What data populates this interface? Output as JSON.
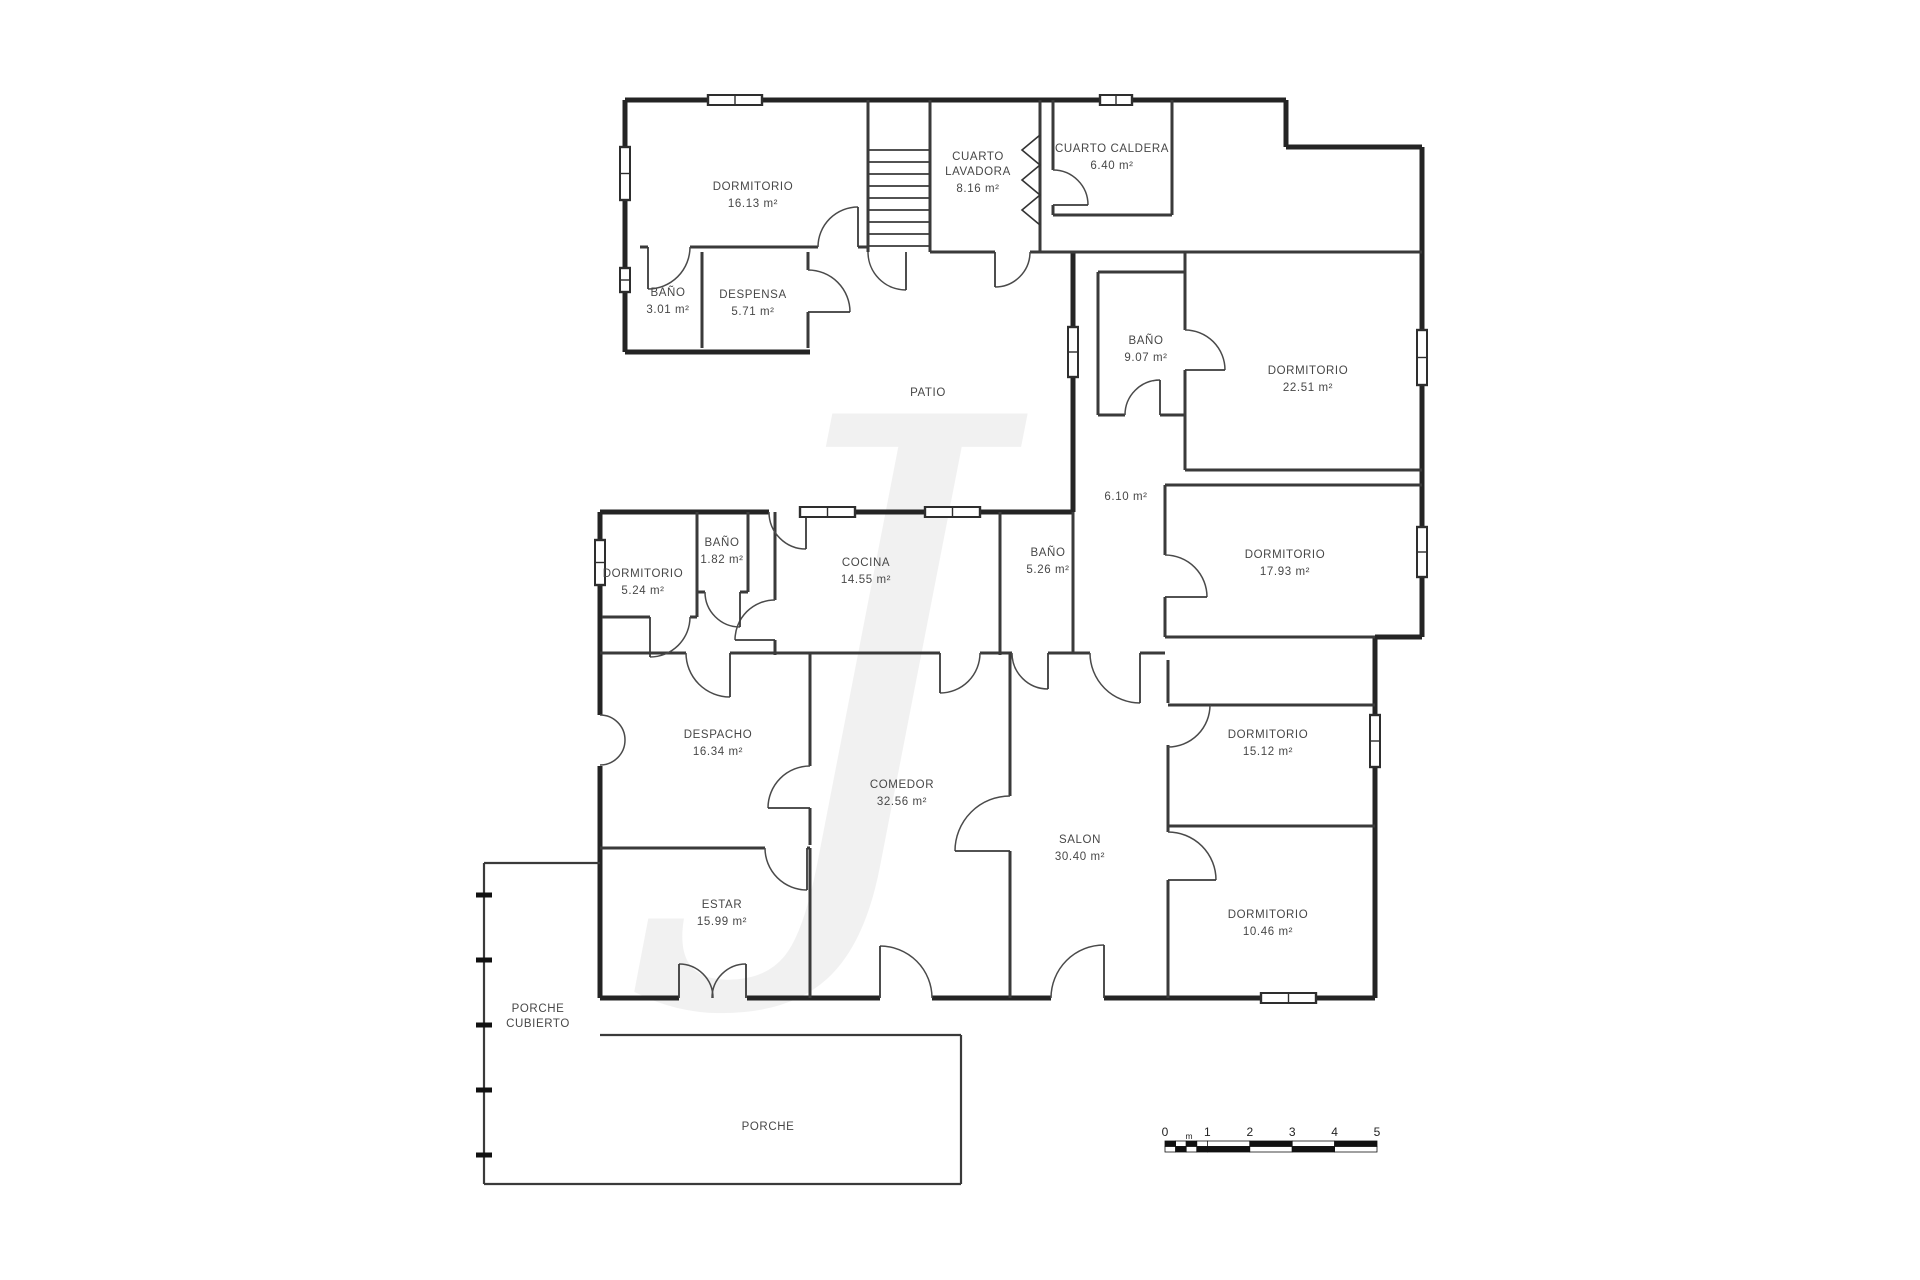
{
  "plan": {
    "rooms": [
      {
        "id": "dormitorio-16",
        "lines": [
          "DORMITORIO"
        ],
        "area": "16.13 m²",
        "x": 753,
        "y": 190
      },
      {
        "id": "cuarto-lavadora",
        "lines": [
          "CUARTO",
          "LAVADORA"
        ],
        "area": "8.16 m²",
        "x": 978,
        "y": 160
      },
      {
        "id": "cuarto-caldera",
        "lines": [
          "CUARTO CALDERA"
        ],
        "area": "6.40 m²",
        "x": 1112,
        "y": 152
      },
      {
        "id": "bano-3-01",
        "lines": [
          "BAÑO"
        ],
        "area": "3.01 m²",
        "x": 668,
        "y": 296
      },
      {
        "id": "despensa",
        "lines": [
          "DESPENSA"
        ],
        "area": "5.71 m²",
        "x": 753,
        "y": 298
      },
      {
        "id": "patio",
        "lines": [
          "PATIO"
        ],
        "area": "",
        "x": 928,
        "y": 396
      },
      {
        "id": "bano-9-07",
        "lines": [
          "BAÑO"
        ],
        "area": "9.07 m²",
        "x": 1146,
        "y": 344
      },
      {
        "id": "dormitorio-22-51",
        "lines": [
          "DORMITORIO"
        ],
        "area": "22.51 m²",
        "x": 1308,
        "y": 374
      },
      {
        "id": "distribuidor",
        "lines": [],
        "area": "6.10 m²",
        "x": 1126,
        "y": 500
      },
      {
        "id": "dormitorio-17-93",
        "lines": [
          "DORMITORIO"
        ],
        "area": "17.93 m²",
        "x": 1285,
        "y": 558
      },
      {
        "id": "dormitorio-5-24",
        "lines": [
          "DORMITORIO"
        ],
        "area": "5.24 m²",
        "x": 643,
        "y": 577
      },
      {
        "id": "bano-1-82",
        "lines": [
          "BAÑO"
        ],
        "area": "1.82 m²",
        "x": 722,
        "y": 546
      },
      {
        "id": "cocina",
        "lines": [
          "COCINA"
        ],
        "area": "14.55 m²",
        "x": 866,
        "y": 566
      },
      {
        "id": "bano-5-26",
        "lines": [
          "BAÑO"
        ],
        "area": "5.26 m²",
        "x": 1048,
        "y": 556
      },
      {
        "id": "despacho",
        "lines": [
          "DESPACHO"
        ],
        "area": "16.34 m²",
        "x": 718,
        "y": 738
      },
      {
        "id": "comedor",
        "lines": [
          "COMEDOR"
        ],
        "area": "32.56 m²",
        "x": 902,
        "y": 788
      },
      {
        "id": "salon",
        "lines": [
          "SALON"
        ],
        "area": "30.40 m²",
        "x": 1080,
        "y": 843
      },
      {
        "id": "dormitorio-15-12",
        "lines": [
          "DORMITORIO"
        ],
        "area": "15.12 m²",
        "x": 1268,
        "y": 738
      },
      {
        "id": "estar",
        "lines": [
          "ESTAR"
        ],
        "area": "15.99 m²",
        "x": 722,
        "y": 908
      },
      {
        "id": "dormitorio-10-46",
        "lines": [
          "DORMITORIO"
        ],
        "area": "10.46 m²",
        "x": 1268,
        "y": 918
      },
      {
        "id": "porche-cubierto",
        "lines": [
          "PORCHE",
          "CUBIERTO"
        ],
        "area": "",
        "x": 538,
        "y": 1012
      },
      {
        "id": "porche",
        "lines": [
          "PORCHE"
        ],
        "area": "",
        "x": 768,
        "y": 1130
      }
    ]
  },
  "scale_bar": {
    "tick_labels": [
      "0",
      "1",
      "2",
      "3",
      "4",
      "5"
    ],
    "unit_label": "m"
  },
  "watermark": {
    "glyph": "J"
  }
}
